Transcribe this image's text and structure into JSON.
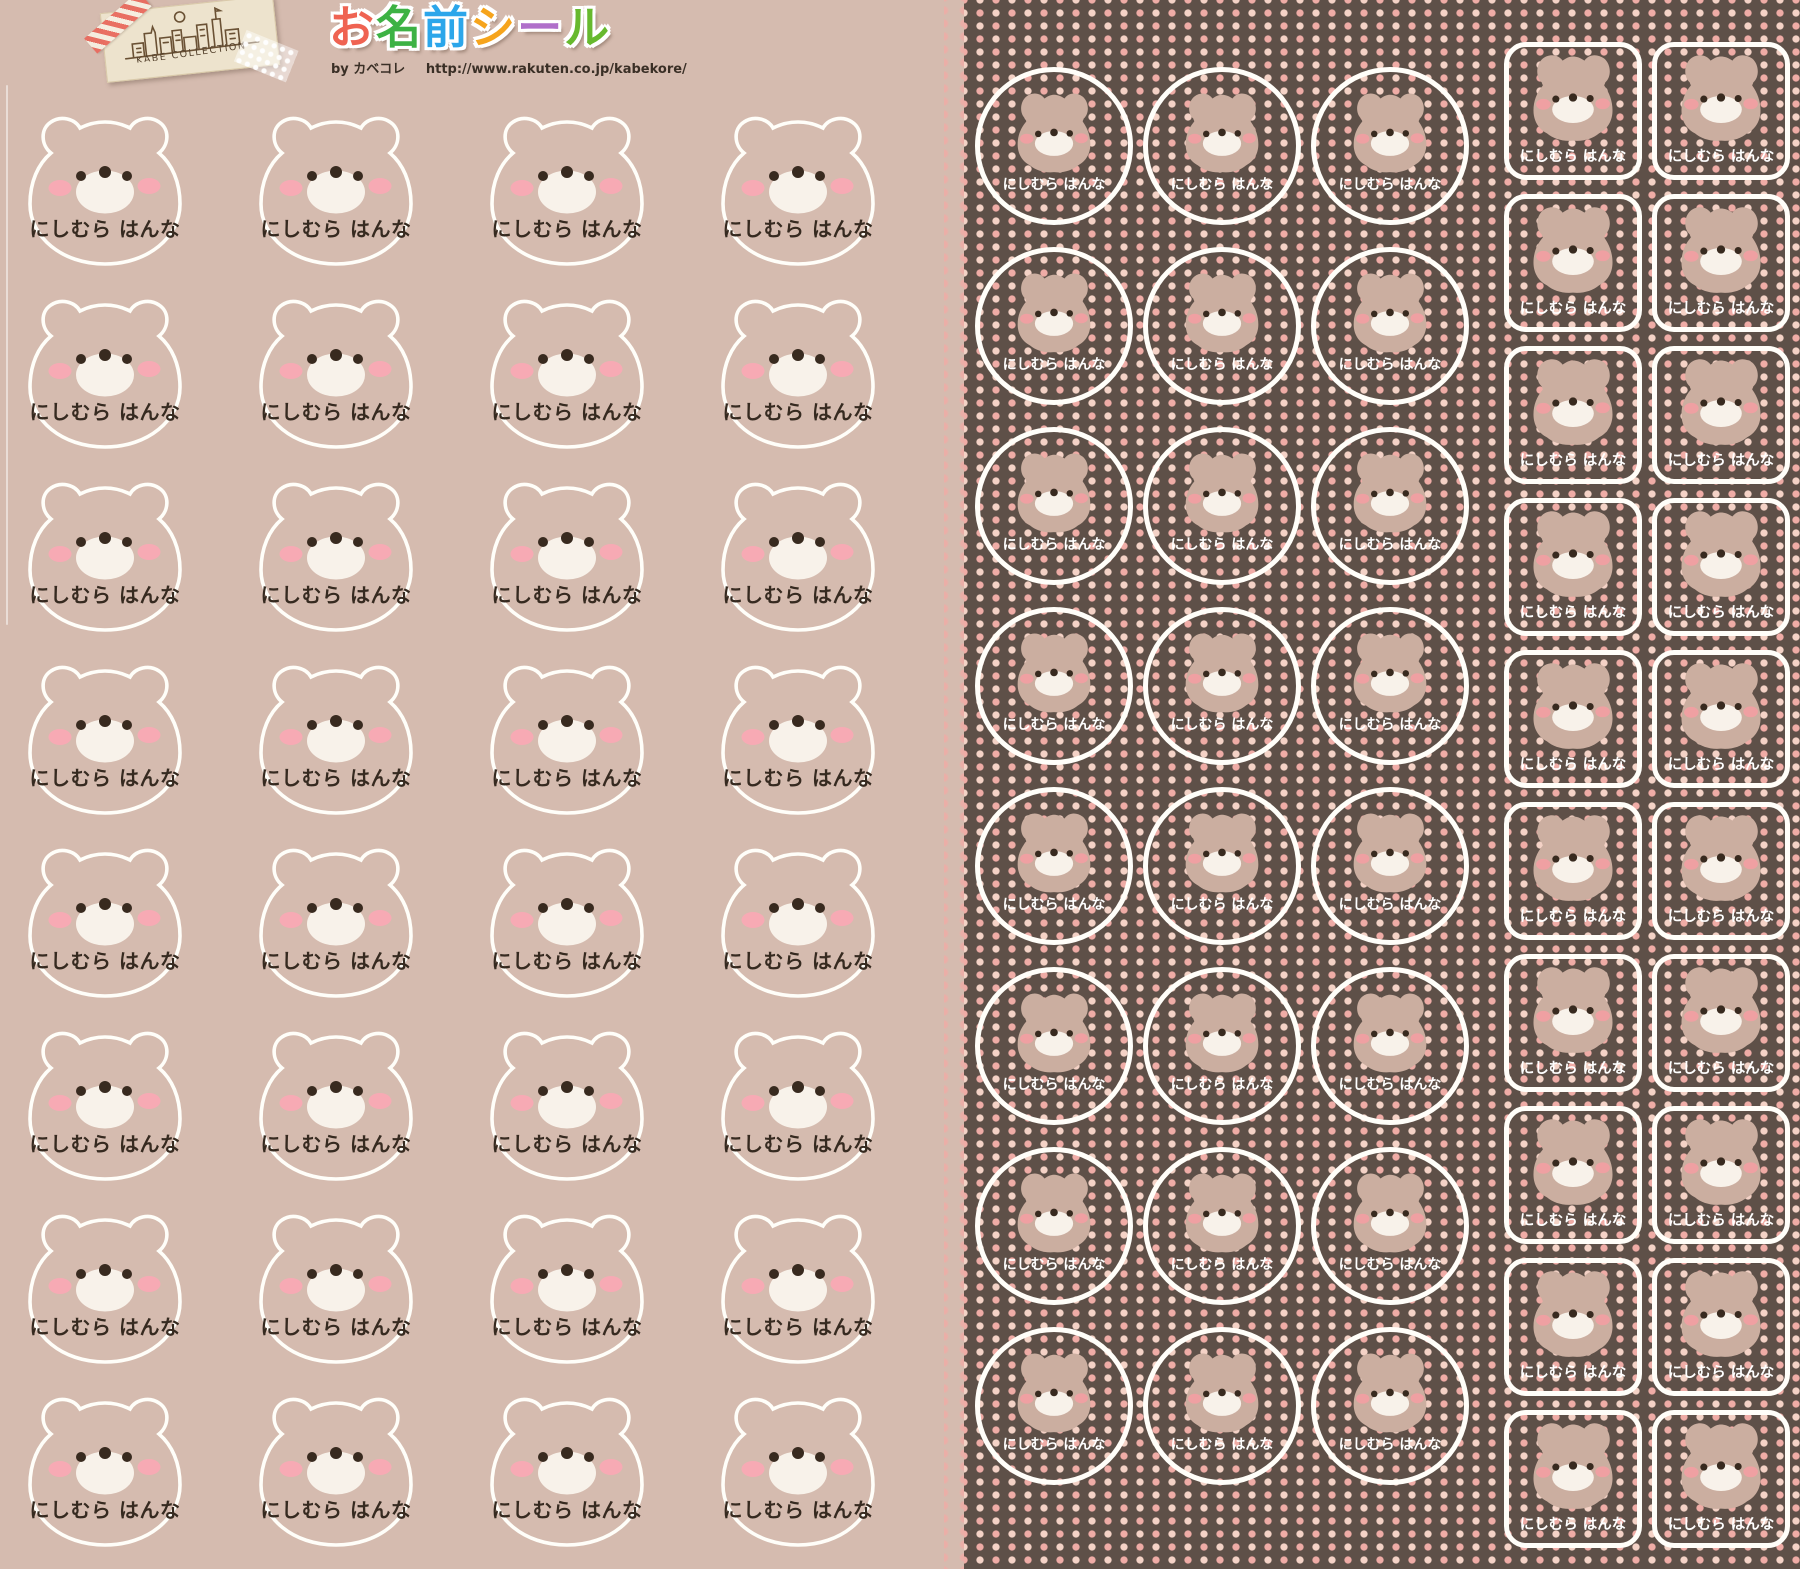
{
  "header": {
    "logo_text": "KABE COLLECTION",
    "title_text": "お名前シール",
    "title_chars": [
      {
        "ch": "お",
        "color": "#ef6352"
      },
      {
        "ch": "名",
        "color": "#3db244"
      },
      {
        "ch": "前",
        "color": "#2ca6ea"
      },
      {
        "ch": "シ",
        "color": "#f6a41c"
      },
      {
        "ch": "ー",
        "color": "#b06fca"
      },
      {
        "ch": "ル",
        "color": "#67b92e"
      }
    ],
    "byline": "by カベコレ",
    "url": "http://www.rakuten.co.jp/kabekore/"
  },
  "sticker_name": "にしむら はんな",
  "sheets": {
    "left": {
      "shape": "bear-head-outline",
      "columns": 4,
      "rows": 8,
      "count": 32
    },
    "circles": {
      "shape": "circle",
      "columns": 3,
      "rows": 8,
      "count": 24
    },
    "squares": {
      "shape": "rounded-square",
      "columns": 2,
      "rows": 10,
      "count": 20
    }
  },
  "colors": {
    "left_bg": "#d5bbaf",
    "right_bg": "#5e5048",
    "dot_pink": "#efaca6",
    "dot_pale": "#f4d2c6",
    "bear_fill": "#cbaea0",
    "muzzle": "#f8f2ea",
    "eye": "#382a1f",
    "cheek_light": "#f7aab4",
    "cheek_deep": "#efa0a2",
    "name_dark": "#362a20",
    "name_light": "#ffffff",
    "sticker_outline": "#fffef9"
  }
}
